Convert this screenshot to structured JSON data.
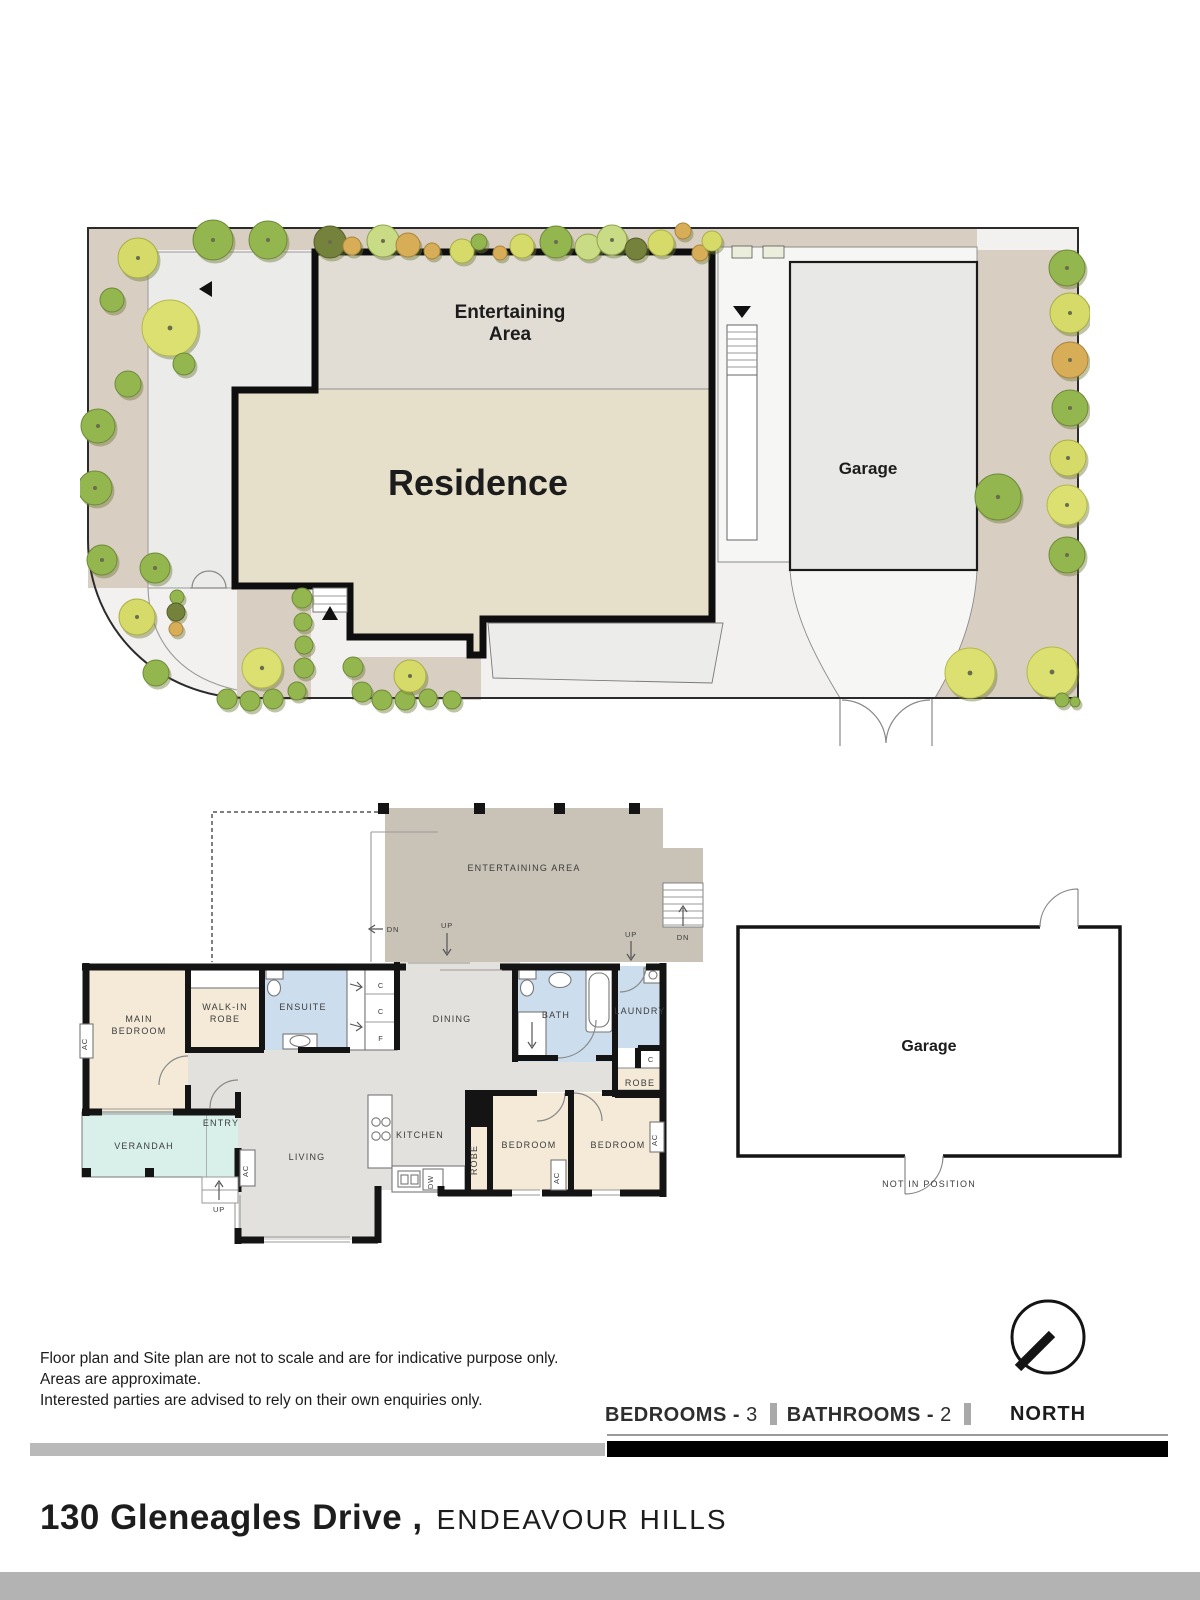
{
  "site_plan": {
    "entertaining_line1": "Entertaining",
    "entertaining_line2": "Area",
    "residence": "Residence",
    "garage": "Garage"
  },
  "floor_plan": {
    "rooms": {
      "entertaining": "ENTERTAINING AREA",
      "main_bedroom_1": "MAIN",
      "main_bedroom_2": "BEDROOM",
      "walk_in_robe_1": "WALK-IN",
      "walk_in_robe_2": "ROBE",
      "ensuite": "ENSUITE",
      "dining": "DINING",
      "bath": "BATH",
      "laundry": "LAUNDRY",
      "robe": "ROBE",
      "verandah": "VERANDAH",
      "entry": "ENTRY",
      "living": "LIVING",
      "kitchen": "KITCHEN",
      "bedroom": "BEDROOM",
      "garage": "Garage"
    },
    "annotations": {
      "ac": "AC",
      "c": "C",
      "f": "F",
      "dw": "DW",
      "up": "UP",
      "dn": "DN",
      "not_in_position": "NOT IN POSITION"
    }
  },
  "footer": {
    "disclaimer_lines": [
      "Floor plan and Site plan are not to scale and are for indicative purpose only.",
      "Areas are approximate.",
      "Interested parties are advised to rely on their own enquiries only."
    ],
    "stats": {
      "bedrooms_label": "BEDROOMS -",
      "bedrooms_value": "3",
      "bathrooms_label": "BATHROOMS -",
      "bathrooms_value": "2"
    },
    "north": "NORTH",
    "address": {
      "street": "130 Gleneagles Drive ,",
      "suburb": "ENDEAVOUR HILLS"
    }
  },
  "colors": {
    "garden": "#d9cec2",
    "path": "#f2f1ef",
    "residence": "#e6dfc9",
    "entertaining_site": "#e1ddd4",
    "garage": "#e8e8e6",
    "plan_entertaining": "#c9c2b6",
    "plan_floor": "#e3e1dd",
    "plan_bedroom": "#f4ead7",
    "plan_wet": "#ccdded",
    "plan_verandah": "#d9f0ea",
    "wall": "#141414",
    "bar_gray": "#b9b9b9",
    "bar_black": "#000000"
  }
}
